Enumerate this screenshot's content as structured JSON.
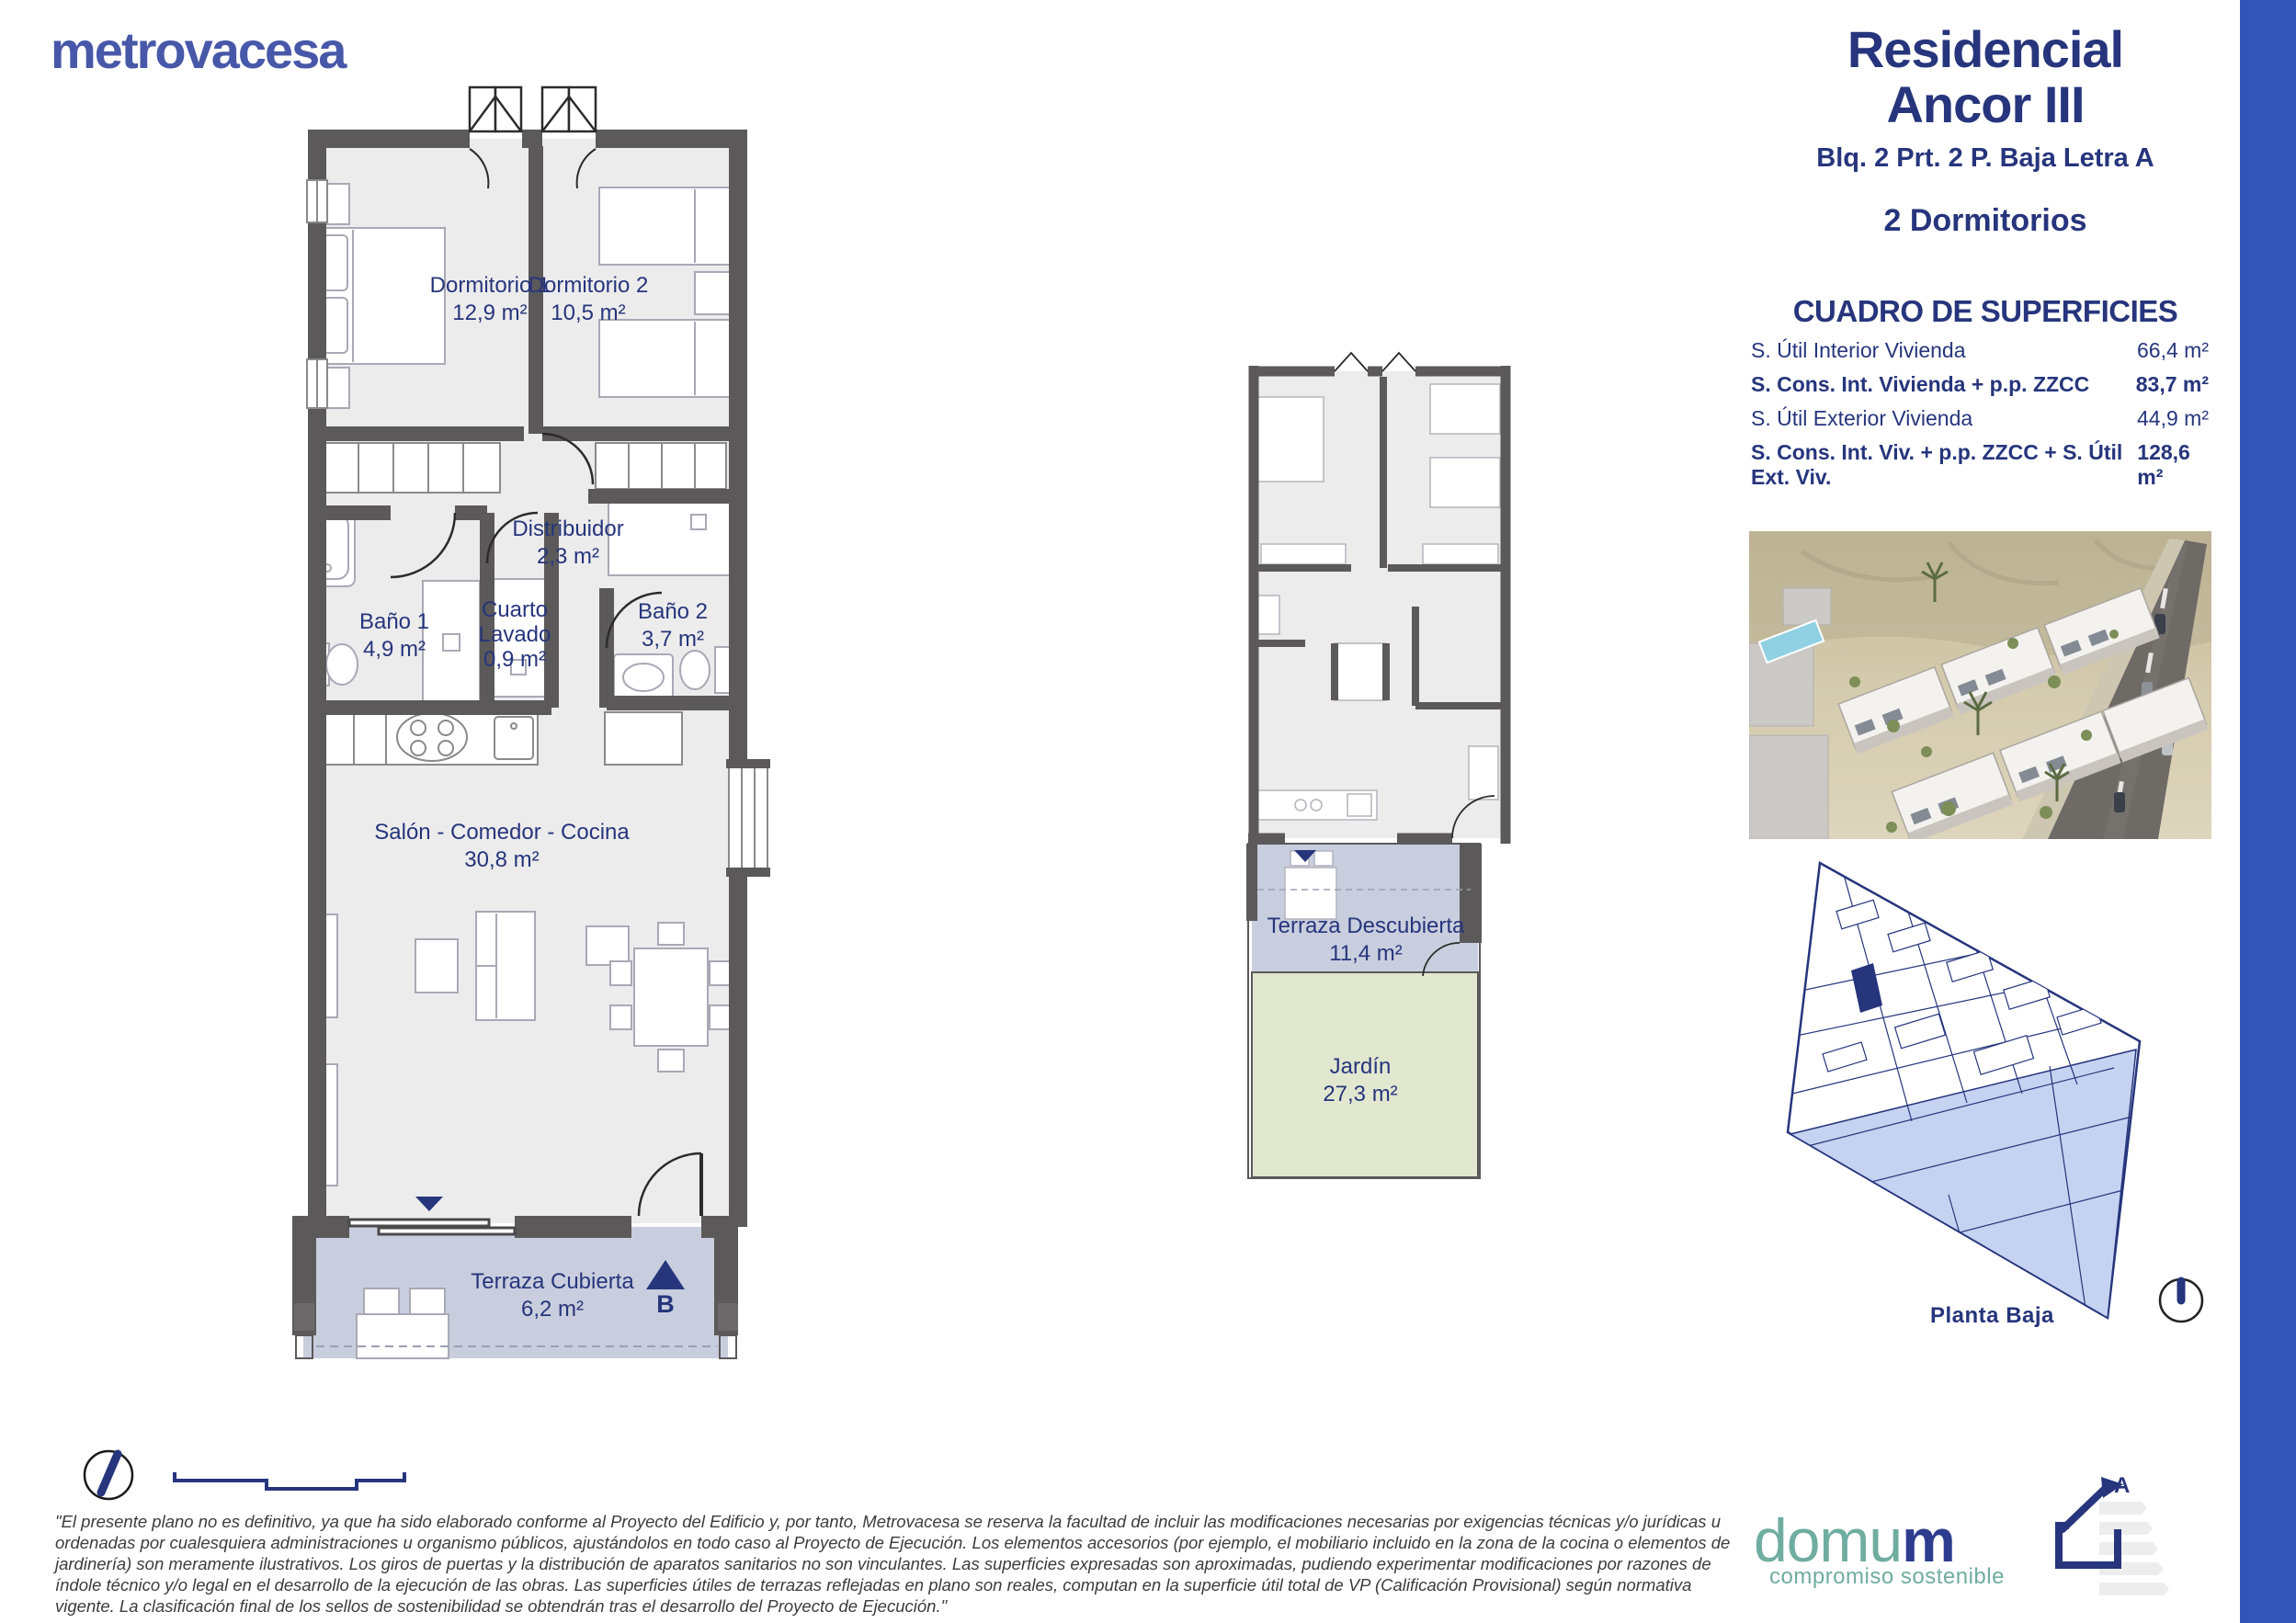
{
  "brand": {
    "logo_text": "metrovacesa"
  },
  "header": {
    "title_line1": "Residencial",
    "title_line2": "Ancor III",
    "subtitle": "Blq. 2 Prt. 2 P. Baja Letra A",
    "bedrooms": "2 Dormitorios"
  },
  "surfaces": {
    "title": "CUADRO DE SUPERFICIES",
    "rows": [
      {
        "label": "S. Útil Interior Vivienda",
        "value": "66,4 m²",
        "bold": false
      },
      {
        "label": "S. Cons. Int. Vivienda + p.p. ZZCC",
        "value": "83,7 m²",
        "bold": true
      },
      {
        "label": "S. Útil Exterior Vivienda",
        "value": "44,9 m²",
        "bold": false
      },
      {
        "label": "S. Cons. Int. Viv. + p.p. ZZCC + S. Útil Ext. Viv.",
        "value": "128,6 m²",
        "bold": true
      }
    ]
  },
  "floorplan": {
    "rooms": [
      {
        "name": "Dormitorio 1",
        "area": "12,9 m²"
      },
      {
        "name": "Dormitorio 2",
        "area": "10,5 m²"
      },
      {
        "name": "Distribuidor",
        "area": "2,3 m²"
      },
      {
        "name": "Baño 1",
        "area": "4,9 m²"
      },
      {
        "name": "Cuarto Lavado",
        "area": "0,9 m²"
      },
      {
        "name": "Baño 2",
        "area": "3,7 m²"
      },
      {
        "name": "Salón - Comedor - Cocina",
        "area": "30,8 m²"
      },
      {
        "name": "Terraza Cubierta",
        "area": "6,2 m²"
      }
    ],
    "entrance_label": "B"
  },
  "miniplan": {
    "rooms": [
      {
        "name": "Terraza Descubierta",
        "area": "11,4 m²"
      },
      {
        "name": "Jardín",
        "area": "27,3 m²"
      }
    ]
  },
  "siteplan": {
    "caption": "Planta Baja"
  },
  "footer": {
    "disclaimer": "\"El presente plano no es definitivo, ya que ha sido elaborado conforme al Proyecto del Edificio y, por tanto, Metrovacesa se reserva la facultad de incluir las modificaciones necesarias por exigencias técnicas y/o jurídicas u ordenadas por cualesquiera administraciones u organismo públicos, ajustándolos en todo caso al Proyecto de Ejecución. Los elementos accesorios (por ejemplo, el mobiliario incluido en la zona de la cocina o elementos de jardinería) son meramente ilustrativos. Los giros de puertas y la distribución de aparatos sanitarios no son vinculantes. Las superficies expresadas son aproximadas, pudiendo experimentar modificaciones por razones de índole técnico y/o legal en el desarrollo de la ejecución de las obras. Las superficies útiles de terrazas reflejadas en plano son reales, computan en la superficie útil total de VP (Calificación Provisional) según normativa vigente. La clasificación final de los sellos de sostenibilidad se obtendrán tras el desarrollo del Proyecto de Ejecución.\"",
    "domum_part1": "domu",
    "domum_part2": "m",
    "domum_tagline": "compromiso sostenible",
    "energy_label": "A"
  },
  "colors": {
    "navy": "#26357c",
    "logo_blue": "#4758a9",
    "teal": "#6fada0",
    "right_bar_blue": "#3355b8",
    "wall_gray": "#5b5959",
    "floor_gray": "#edecec",
    "terrace_blue": "#c9cede",
    "garden_green": "#e2e7d0",
    "siteplan_blue": "#c6d2f1"
  }
}
